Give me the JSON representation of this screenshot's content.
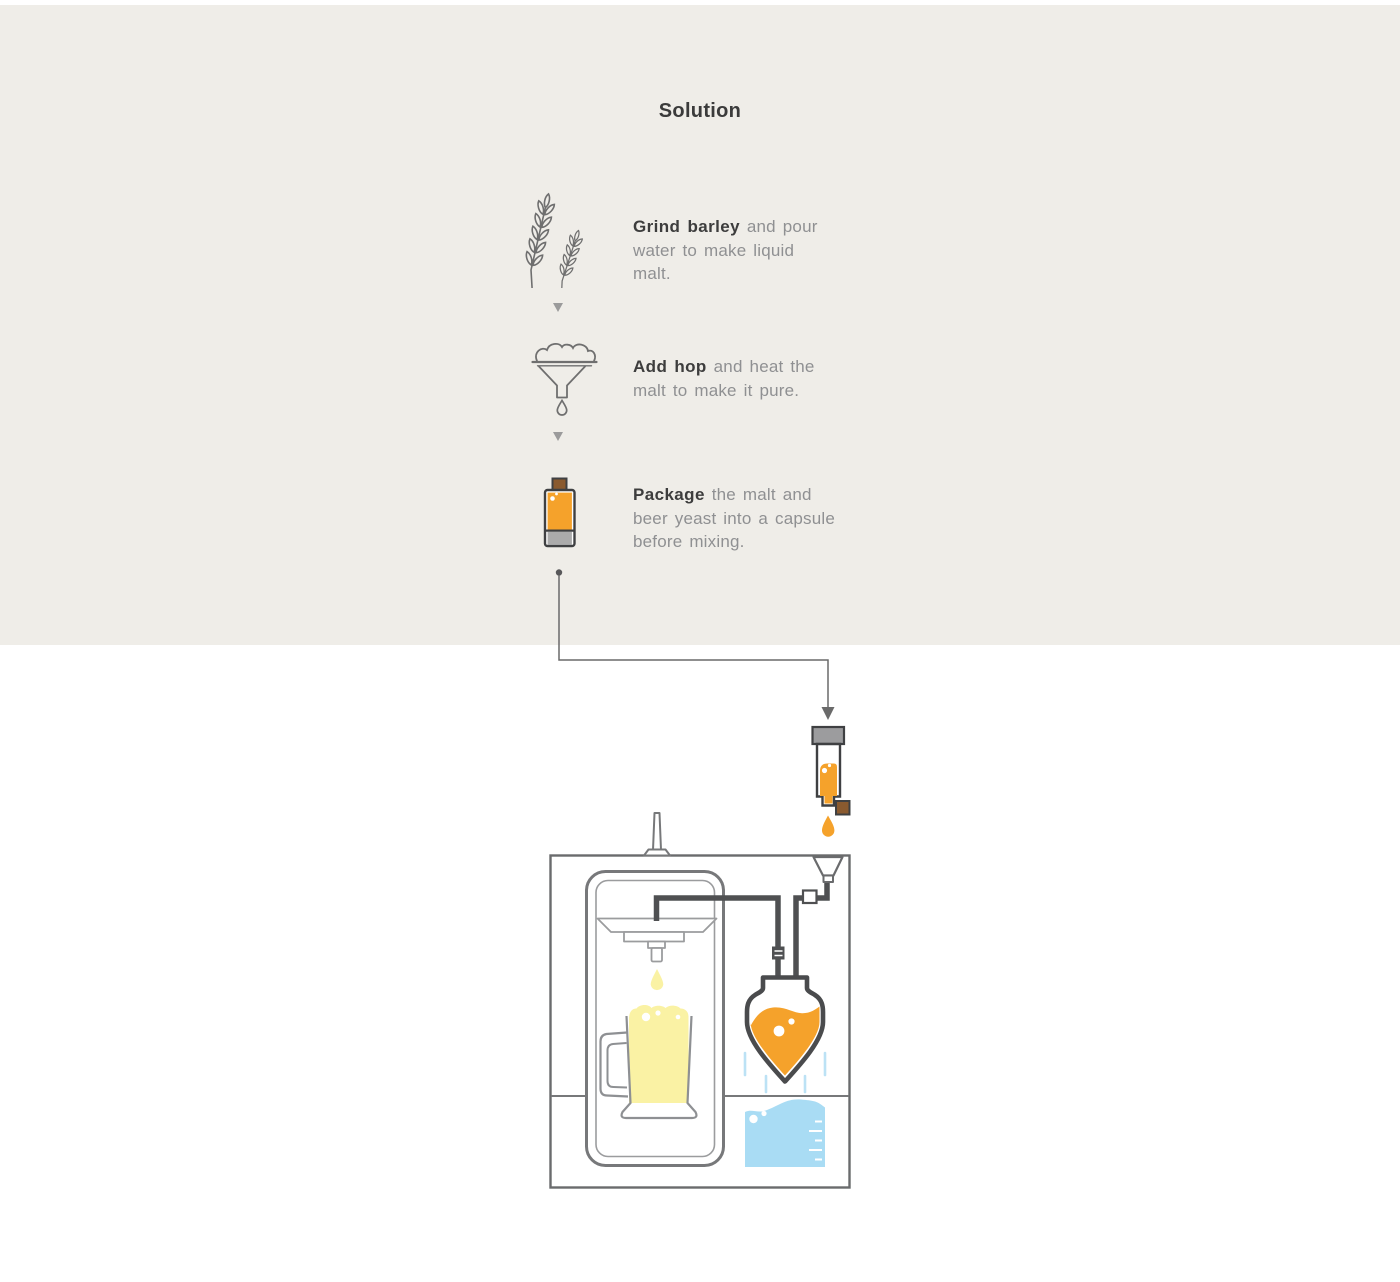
{
  "title": "Solution",
  "colors": {
    "background_top": "#EFEDE8",
    "background_bottom": "#FFFFFF",
    "accent_orange": "#F5A22B",
    "beer_yellow": "#FAF2A4",
    "water_blue": "#A9DCF4",
    "steam_blue": "#BCE2F5",
    "capsule_cap_gray": "#9C9C9E",
    "capsule_bottom_gray": "#ABABAB",
    "cap_brown": "#8A5A2F",
    "text_dark": "#3D3D3D",
    "text_gray": "#8F9092",
    "icon_gray": "#6F6F6F",
    "pipe_dark": "#4F5052",
    "machine_border": "#6A6B6D"
  },
  "steps": [
    {
      "icon": "barley-icon",
      "bold": "Grind barley",
      "line1_rest": " and pour",
      "line2": "water to make liquid",
      "line3": "malt."
    },
    {
      "icon": "hop-funnel-icon",
      "bold": "Add hop",
      "line1_rest": " and heat the",
      "line2": "malt to make it pure.",
      "line3": ""
    },
    {
      "icon": "capsule-icon",
      "bold": "Package",
      "line1_rest": " the malt and",
      "line2": "beer yeast into a capsule",
      "line3": "before mixing."
    }
  ],
  "machine": {
    "parts": [
      "connector-line",
      "capsule",
      "capsule-drop",
      "inlet-funnel",
      "tap-handle",
      "machine-body",
      "brew-chamber",
      "dispenser",
      "beer-drop",
      "beer-mug",
      "pipes",
      "fermenter-vessel",
      "steam-lines",
      "water-tank"
    ]
  }
}
